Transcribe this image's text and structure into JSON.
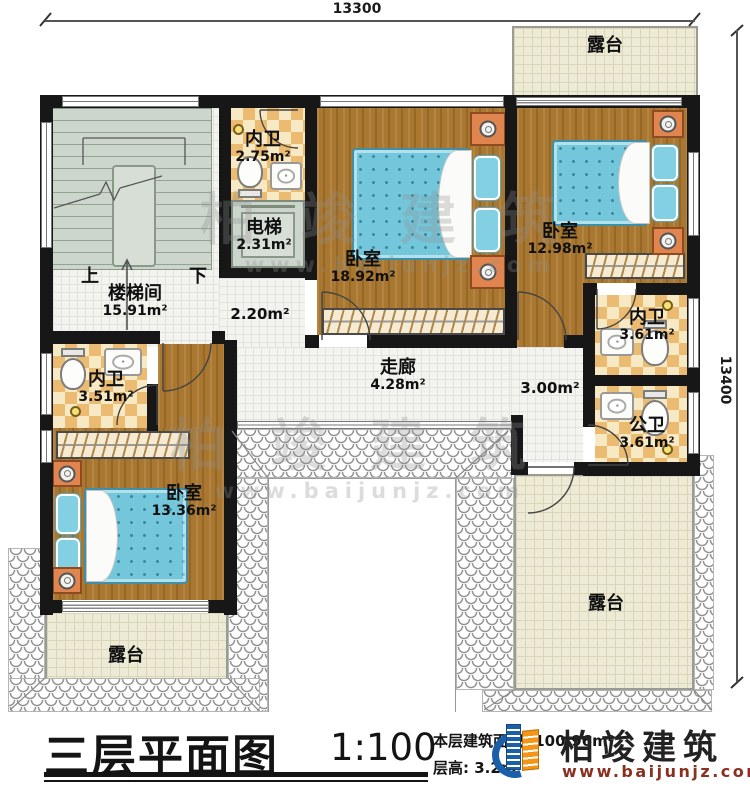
{
  "dimensions": {
    "top": "13300",
    "right": "13400"
  },
  "rooms": {
    "terrace_top": {
      "name": "露台"
    },
    "terrace_bottom_left": {
      "name": "露台"
    },
    "terrace_bottom_right": {
      "name": "露台"
    },
    "stairwell": {
      "name": "楼梯间",
      "area": "15.91m²"
    },
    "stairs": {
      "up": "上",
      "down": "下"
    },
    "bath_upper": {
      "name": "内卫",
      "area": "2.75m²"
    },
    "elevator": {
      "name": "电梯",
      "area": "2.31m²"
    },
    "elevator_lobby": {
      "area": "2.20m²"
    },
    "bedroom_master": {
      "name": "卧室",
      "area": "18.92m²"
    },
    "bedroom_right": {
      "name": "卧室",
      "area": "12.98m²"
    },
    "bath_right": {
      "name": "内卫",
      "area": "3.61m²"
    },
    "bath_public": {
      "name": "公卫",
      "area": "3.61m²"
    },
    "corridor": {
      "name": "走廊",
      "area": "4.28m²"
    },
    "landing": {
      "area": "3.00m²"
    },
    "bath_left": {
      "name": "内卫",
      "area": "3.51m²"
    },
    "bedroom_lower": {
      "name": "卧室",
      "area": "13.36m²"
    }
  },
  "title": {
    "main": "三层平面图",
    "scale": "1:100",
    "area_line": "本层建筑面积: 100.96m²",
    "floor_height_line": "层高: 3.2m"
  },
  "brand": {
    "name": "柏竣建筑",
    "website": "www.baijunjz.com"
  },
  "watermark": {
    "text": "柏竣建筑",
    "website": "www.baijunjz.com"
  },
  "colors": {
    "wall": "#171717",
    "wood_floor": "#a9772f",
    "bath_tile": "#eabb70",
    "terrace": "#edead6",
    "stairs": "#cdd6cd",
    "bed": "#74c6da",
    "brand_blue": "#1a5fa8",
    "brand_orange": "#f39516",
    "brand_url_red": "#8b2f1f"
  }
}
